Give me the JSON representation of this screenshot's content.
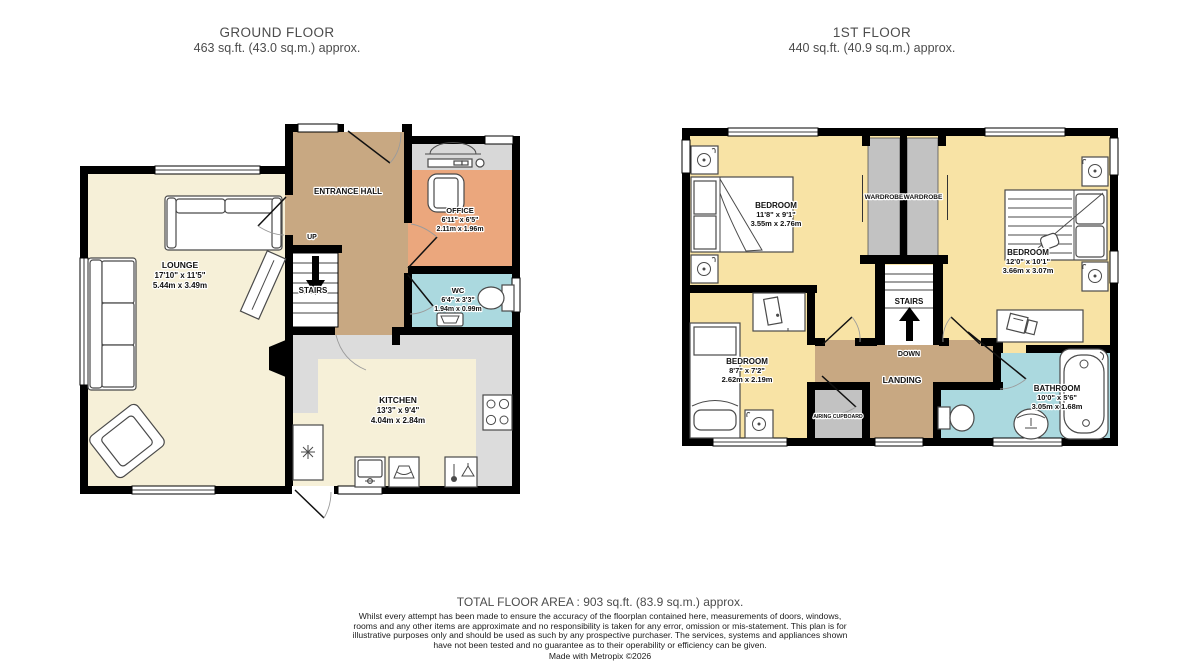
{
  "titles": {
    "ground": {
      "title": "GROUND FLOOR",
      "area": "463 sq.ft. (43.0 sq.m.) approx."
    },
    "first": {
      "title": "1ST FLOOR",
      "area": "440 sq.ft. (40.9 sq.m.) approx."
    }
  },
  "ground_floor": {
    "lounge": {
      "name": "LOUNGE",
      "ft": "17'10\" x 11'5\"",
      "m": "5.44m x 3.49m"
    },
    "hall": {
      "name": "ENTRANCE HALL"
    },
    "office": {
      "name": "OFFICE",
      "ft": "6'11\" x 6'5\"",
      "m": "2.11m x 1.96m"
    },
    "wc": {
      "name": "WC",
      "ft": "6'4\" x 3'3\"",
      "m": "1.94m x 0.99m"
    },
    "kitchen": {
      "name": "KITCHEN",
      "ft": "13'3\" x 9'4\"",
      "m": "4.04m x 2.84m"
    },
    "stairs": {
      "label": "STAIRS",
      "direction": "UP"
    }
  },
  "first_floor": {
    "bedroom1": {
      "name": "BEDROOM",
      "ft": "11'8\" x 9'1\"",
      "m": "3.55m x 2.76m"
    },
    "bedroom2": {
      "name": "BEDROOM",
      "ft": "12'0\" x 10'1\"",
      "m": "3.66m x 3.07m"
    },
    "bedroom3": {
      "name": "BEDROOM",
      "ft": "8'7\" x 7'2\"",
      "m": "2.62m x 2.19m"
    },
    "bathroom": {
      "name": "BATHROOM",
      "ft": "10'0\" x 5'6\"",
      "m": "3.05m x 1.68m"
    },
    "landing": {
      "name": "LANDING"
    },
    "wardrobe1": {
      "name": "WARDROBE"
    },
    "wardrobe2": {
      "name": "WARDROBE"
    },
    "airing": {
      "name": "AIRING CUPBOARD"
    },
    "stairs": {
      "label": "STAIRS",
      "direction": "DOWN"
    }
  },
  "footer": {
    "total": "TOTAL FLOOR AREA : 903 sq.ft. (83.9 sq.m.) approx.",
    "disclaimer": "Whilst every attempt has been made to ensure the accuracy of the floorplan contained here, measurements of doors, windows, rooms and any other items are approximate and no responsibility is taken for any error, omission or mis-statement. This plan is for illustrative purposes only and should be used as such by any prospective purchaser. The services, systems and appliances shown have not been tested and no guarantee as to their operability or efficiency can be given.",
    "credit": "Made with Metropix ©2026"
  },
  "colors": {
    "room_cream": "#F6F0D8",
    "hall_tan": "#C8A882",
    "office_salmon": "#EBA77D",
    "wet_room_blue": "#ABD9DF",
    "bedroom_yellow": "#F8E3A5",
    "cupboard_gray": "#C2C2C2",
    "counter_gray": "#DCDCDC",
    "wall": "#000000"
  }
}
